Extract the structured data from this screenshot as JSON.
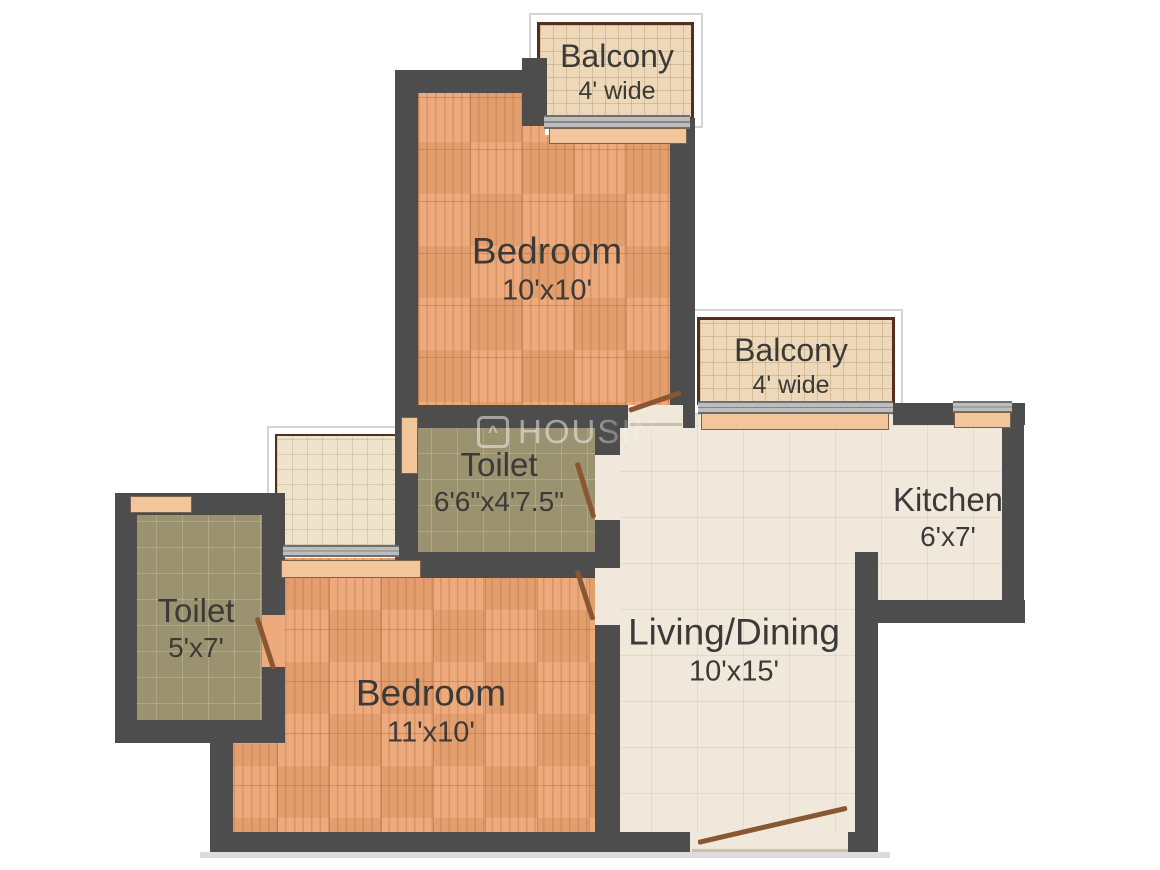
{
  "plan": {
    "rooms": [
      {
        "key": "balcony-top",
        "name": "Balcony",
        "dims": "4' wide"
      },
      {
        "key": "bedroom-top",
        "name": "Bedroom",
        "dims": "10'x10'"
      },
      {
        "key": "balcony-middle",
        "name": "Balcony",
        "dims": "4' wide"
      },
      {
        "key": "toilet-middle",
        "name": "Toilet",
        "dims": "6'6\"x4'7.5\""
      },
      {
        "key": "kitchen",
        "name": "Kitchen",
        "dims": "6'x7'"
      },
      {
        "key": "toilet-left",
        "name": "Toilet",
        "dims": "5'x7'"
      },
      {
        "key": "bedroom-bottom",
        "name": "Bedroom",
        "dims": "11'x10'"
      },
      {
        "key": "living-dining",
        "name": "Living/Dining",
        "dims": "10'x15'"
      }
    ],
    "watermark": {
      "icon": "house-icon",
      "text": "HOUSING"
    },
    "palette": {
      "wall": "#4d4d4d",
      "parquet_floor": "#edaa7c",
      "cream_tile": "#f0e9db",
      "toilet_tile": "#9b9270",
      "balcony_tile": "#edd9ba",
      "balcony_border": "#53301d",
      "window_sill": "#f3c59b",
      "door_leaf": "#8a5733",
      "label_text": "#3b3a38"
    }
  }
}
